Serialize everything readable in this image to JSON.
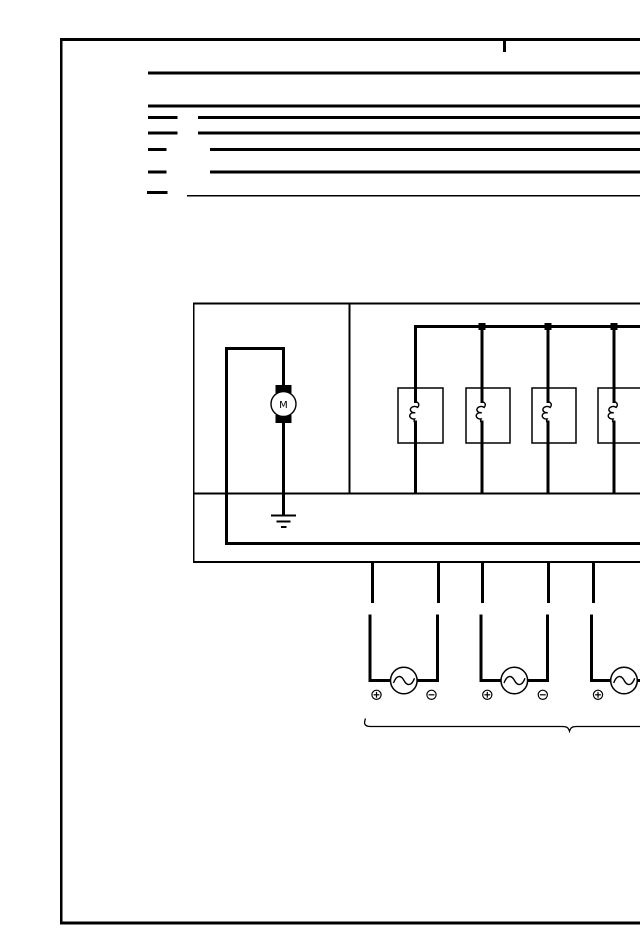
{
  "page": {
    "colors": {
      "ink": "#000000",
      "paper": "#ffffff"
    },
    "kind": "wiring-schematic-fragment"
  },
  "schematic": {
    "motor_label": "M",
    "components": {
      "harness_lines": 7,
      "relay_coil_boxes": 4,
      "bus_junction_dots": 3,
      "ac_sources": 3,
      "ground_symbols": 1,
      "polarity_marks_visible": [
        "+",
        "−",
        "+",
        "−",
        "+"
      ]
    }
  }
}
